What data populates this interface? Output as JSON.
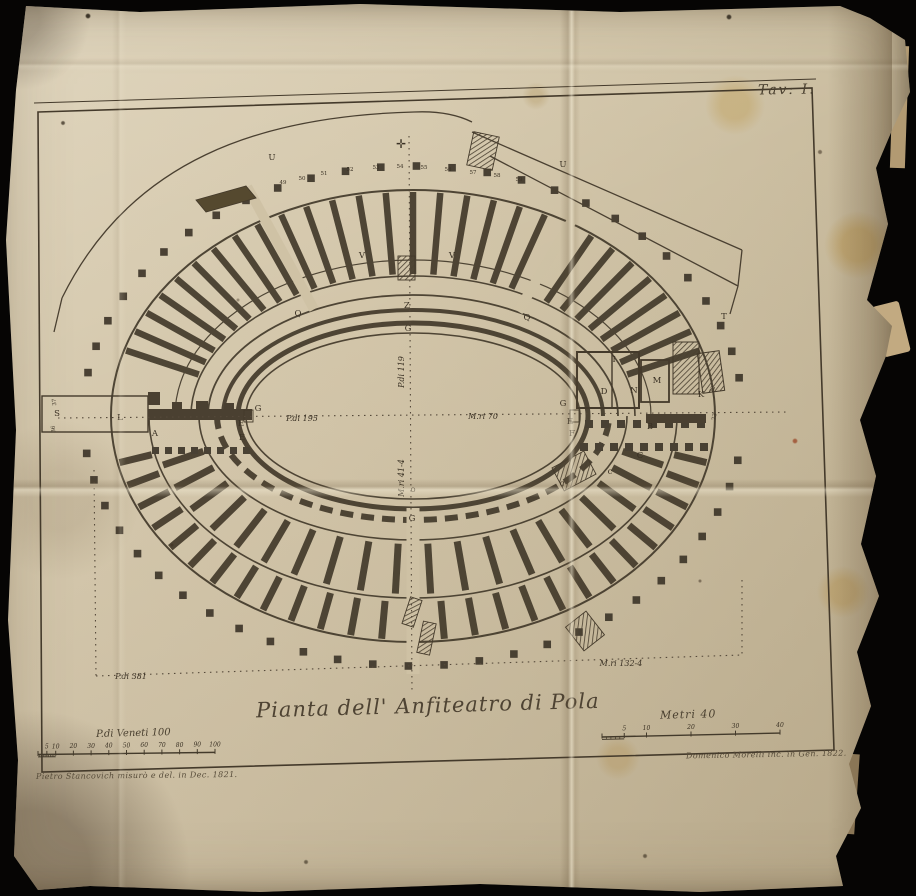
{
  "photo": {
    "background_color": "#060504",
    "paper_color": "#cfc2a5",
    "ink_color": "#433a2b"
  },
  "plate": {
    "plate_number": "Tav: I.",
    "title": "Pianta dell' Anfiteatro di Pola",
    "credits": {
      "left": "Pietro Stancovich misurò e del. in Dec. 1821.",
      "right": "Domenico Morelli inc. in Gen. 1822."
    },
    "scales": {
      "venetian": {
        "label": "P.di Veneti 100",
        "ticks": [
          5,
          10,
          20,
          30,
          40,
          50,
          60,
          70,
          80,
          90,
          100
        ]
      },
      "metric": {
        "label": "Metri 40",
        "ticks": [
          5,
          10,
          20,
          30,
          40
        ]
      }
    },
    "cross_mark": "✛",
    "measurements": [
      {
        "text": "P.di 195",
        "x": 302,
        "y": 421
      },
      {
        "text": "M.ri 70",
        "x": 483,
        "y": 419
      },
      {
        "text": "P.di 119",
        "x": 404,
        "y": 372,
        "rot": -90
      },
      {
        "text": "M.ri 41-4",
        "x": 404,
        "y": 478,
        "rot": -90
      },
      {
        "text": "P.di 381",
        "x": 131,
        "y": 679
      },
      {
        "text": "M.ri 132-4",
        "x": 621,
        "y": 666
      }
    ],
    "letters": [
      {
        "t": "U",
        "x": 272,
        "y": 160
      },
      {
        "t": "U",
        "x": 563,
        "y": 167
      },
      {
        "t": "V",
        "x": 362,
        "y": 258
      },
      {
        "t": "V",
        "x": 452,
        "y": 258
      },
      {
        "t": "Q",
        "x": 298,
        "y": 316
      },
      {
        "t": "Q",
        "x": 527,
        "y": 320
      },
      {
        "t": "Z",
        "x": 407,
        "y": 308
      },
      {
        "t": "G",
        "x": 408,
        "y": 331
      },
      {
        "t": "T",
        "x": 724,
        "y": 319
      },
      {
        "t": "S",
        "x": 57,
        "y": 416
      },
      {
        "t": "L",
        "x": 120,
        "y": 420
      },
      {
        "t": "A",
        "x": 155,
        "y": 436
      },
      {
        "t": "G",
        "x": 258,
        "y": 411
      },
      {
        "t": "E",
        "x": 241,
        "y": 426
      },
      {
        "t": "E",
        "x": 242,
        "y": 440
      },
      {
        "t": "G",
        "x": 563,
        "y": 406
      },
      {
        "t": "E",
        "x": 570,
        "y": 424
      },
      {
        "t": "F",
        "x": 572,
        "y": 436
      },
      {
        "t": "I",
        "x": 614,
        "y": 362
      },
      {
        "t": "D",
        "x": 604,
        "y": 394
      },
      {
        "t": "N",
        "x": 634,
        "y": 393
      },
      {
        "t": "M",
        "x": 657,
        "y": 383
      },
      {
        "t": "K",
        "x": 701,
        "y": 397
      },
      {
        "t": "B",
        "x": 650,
        "y": 429
      },
      {
        "t": "C",
        "x": 640,
        "y": 458
      },
      {
        "t": "c",
        "x": 610,
        "y": 474
      },
      {
        "t": "c",
        "x": 562,
        "y": 486
      },
      {
        "t": "o",
        "x": 413,
        "y": 492
      },
      {
        "t": "G",
        "x": 412,
        "y": 521
      }
    ],
    "pier_numbers": [
      {
        "t": "49",
        "x": 283,
        "y": 184
      },
      {
        "t": "50",
        "x": 302,
        "y": 180
      },
      {
        "t": "51",
        "x": 324,
        "y": 175
      },
      {
        "t": "52",
        "x": 350,
        "y": 171
      },
      {
        "t": "53",
        "x": 376,
        "y": 169
      },
      {
        "t": "54",
        "x": 400,
        "y": 168
      },
      {
        "t": "55",
        "x": 424,
        "y": 169
      },
      {
        "t": "56",
        "x": 448,
        "y": 171
      },
      {
        "t": "57",
        "x": 473,
        "y": 174
      },
      {
        "t": "58",
        "x": 497,
        "y": 177
      },
      {
        "t": "59",
        "x": 519,
        "y": 181
      },
      {
        "t": "72",
        "x": 714,
        "y": 390,
        "rot": -70
      },
      {
        "t": "73",
        "x": 716,
        "y": 417,
        "rot": -80
      },
      {
        "t": "37",
        "x": 56,
        "y": 402,
        "rot": -95
      },
      {
        "t": "36",
        "x": 55,
        "y": 429,
        "rot": -95
      }
    ]
  }
}
